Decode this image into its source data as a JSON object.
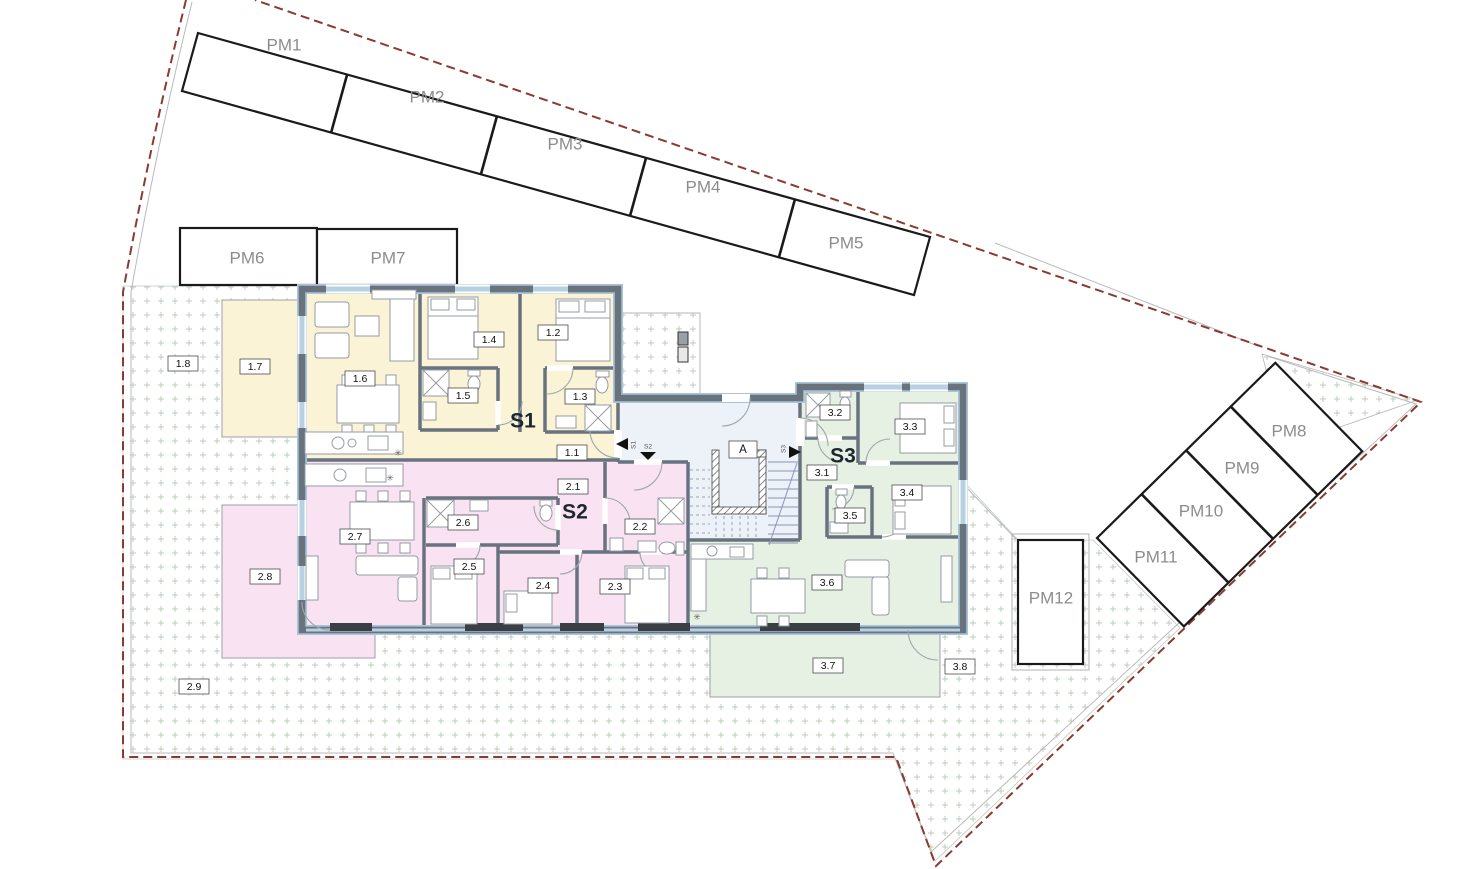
{
  "parking": {
    "top_row": [
      "PM1",
      "PM2",
      "PM3",
      "PM4",
      "PM5"
    ],
    "front_row": [
      "PM6",
      "PM7"
    ],
    "right_band": [
      "PM8",
      "PM9",
      "PM10",
      "PM11"
    ],
    "single": "PM12"
  },
  "apartments": [
    {
      "name": "S1",
      "color": "#faf3d6",
      "rooms": [
        "1.1",
        "1.2",
        "1.3",
        "1.4",
        "1.5",
        "1.6",
        "1.7",
        "1.8"
      ]
    },
    {
      "name": "S2",
      "color": "#f9e2f2",
      "rooms": [
        "2.1",
        "2.2",
        "2.3",
        "2.4",
        "2.5",
        "2.6",
        "2.7",
        "2.8",
        "2.9"
      ]
    },
    {
      "name": "S3",
      "color": "#e6f1e4",
      "rooms": [
        "3.1",
        "3.2",
        "3.3",
        "3.4",
        "3.5",
        "3.6",
        "3.7",
        "3.8"
      ]
    }
  ],
  "stairwell": {
    "label": "A"
  },
  "entrances": [
    "S1",
    "S2",
    "S3"
  ],
  "symbols": {
    "boiler": "✳"
  },
  "colors": {
    "boundary_red": "#8a3a2f",
    "garden_dots": "#b7c9b7",
    "wall_gray": "#68737e",
    "window_blue": "#b7d0e2",
    "hall_blue": "#edf2f8",
    "parking_text": "#8c8c8c"
  }
}
